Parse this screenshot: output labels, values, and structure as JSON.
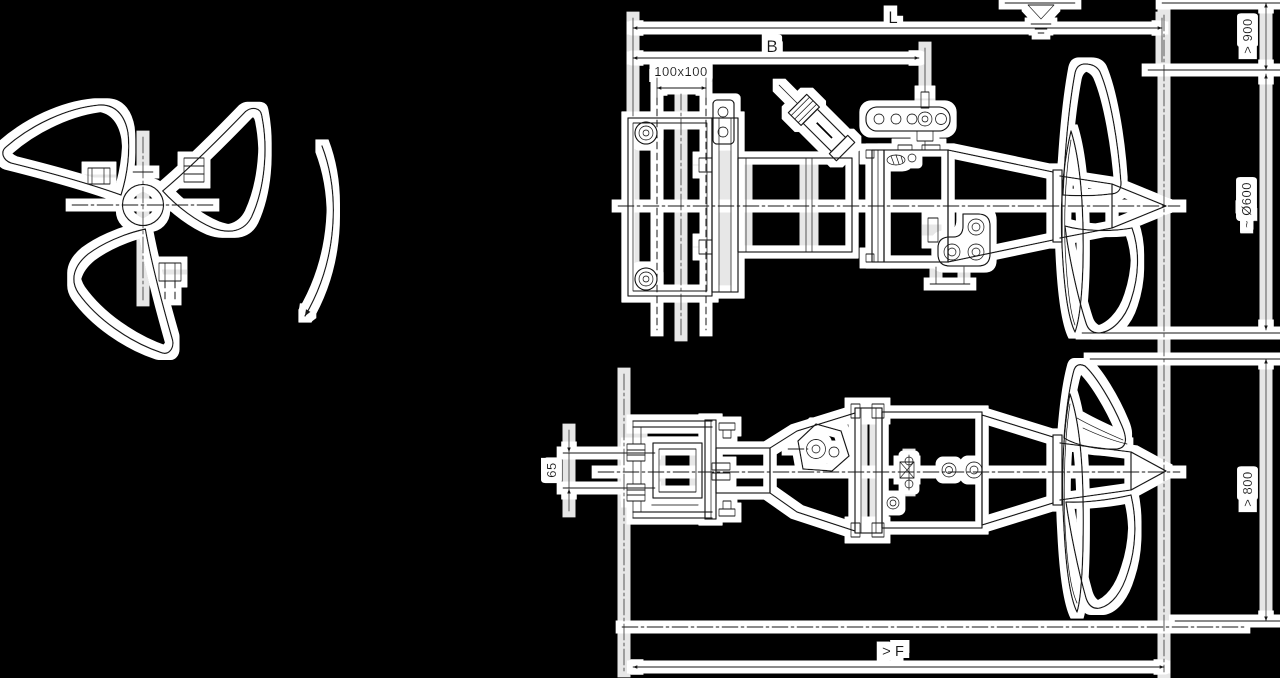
{
  "drawing": {
    "title": "submersible-mixer-installation-drawing",
    "side_view": {
      "dim_length_label": "L",
      "dim_bracket_label": "B",
      "dim_guide_bar": "100x100",
      "dim_submergence": "> 900",
      "dim_propeller_diameter": "~ Ø600"
    },
    "plan_view": {
      "dim_offset": "65",
      "dim_clearance": "> 800",
      "dim_floor_distance": "> F"
    },
    "colors": {
      "background": "#000000",
      "ink": "#141414",
      "halo": "#ffffff"
    }
  }
}
